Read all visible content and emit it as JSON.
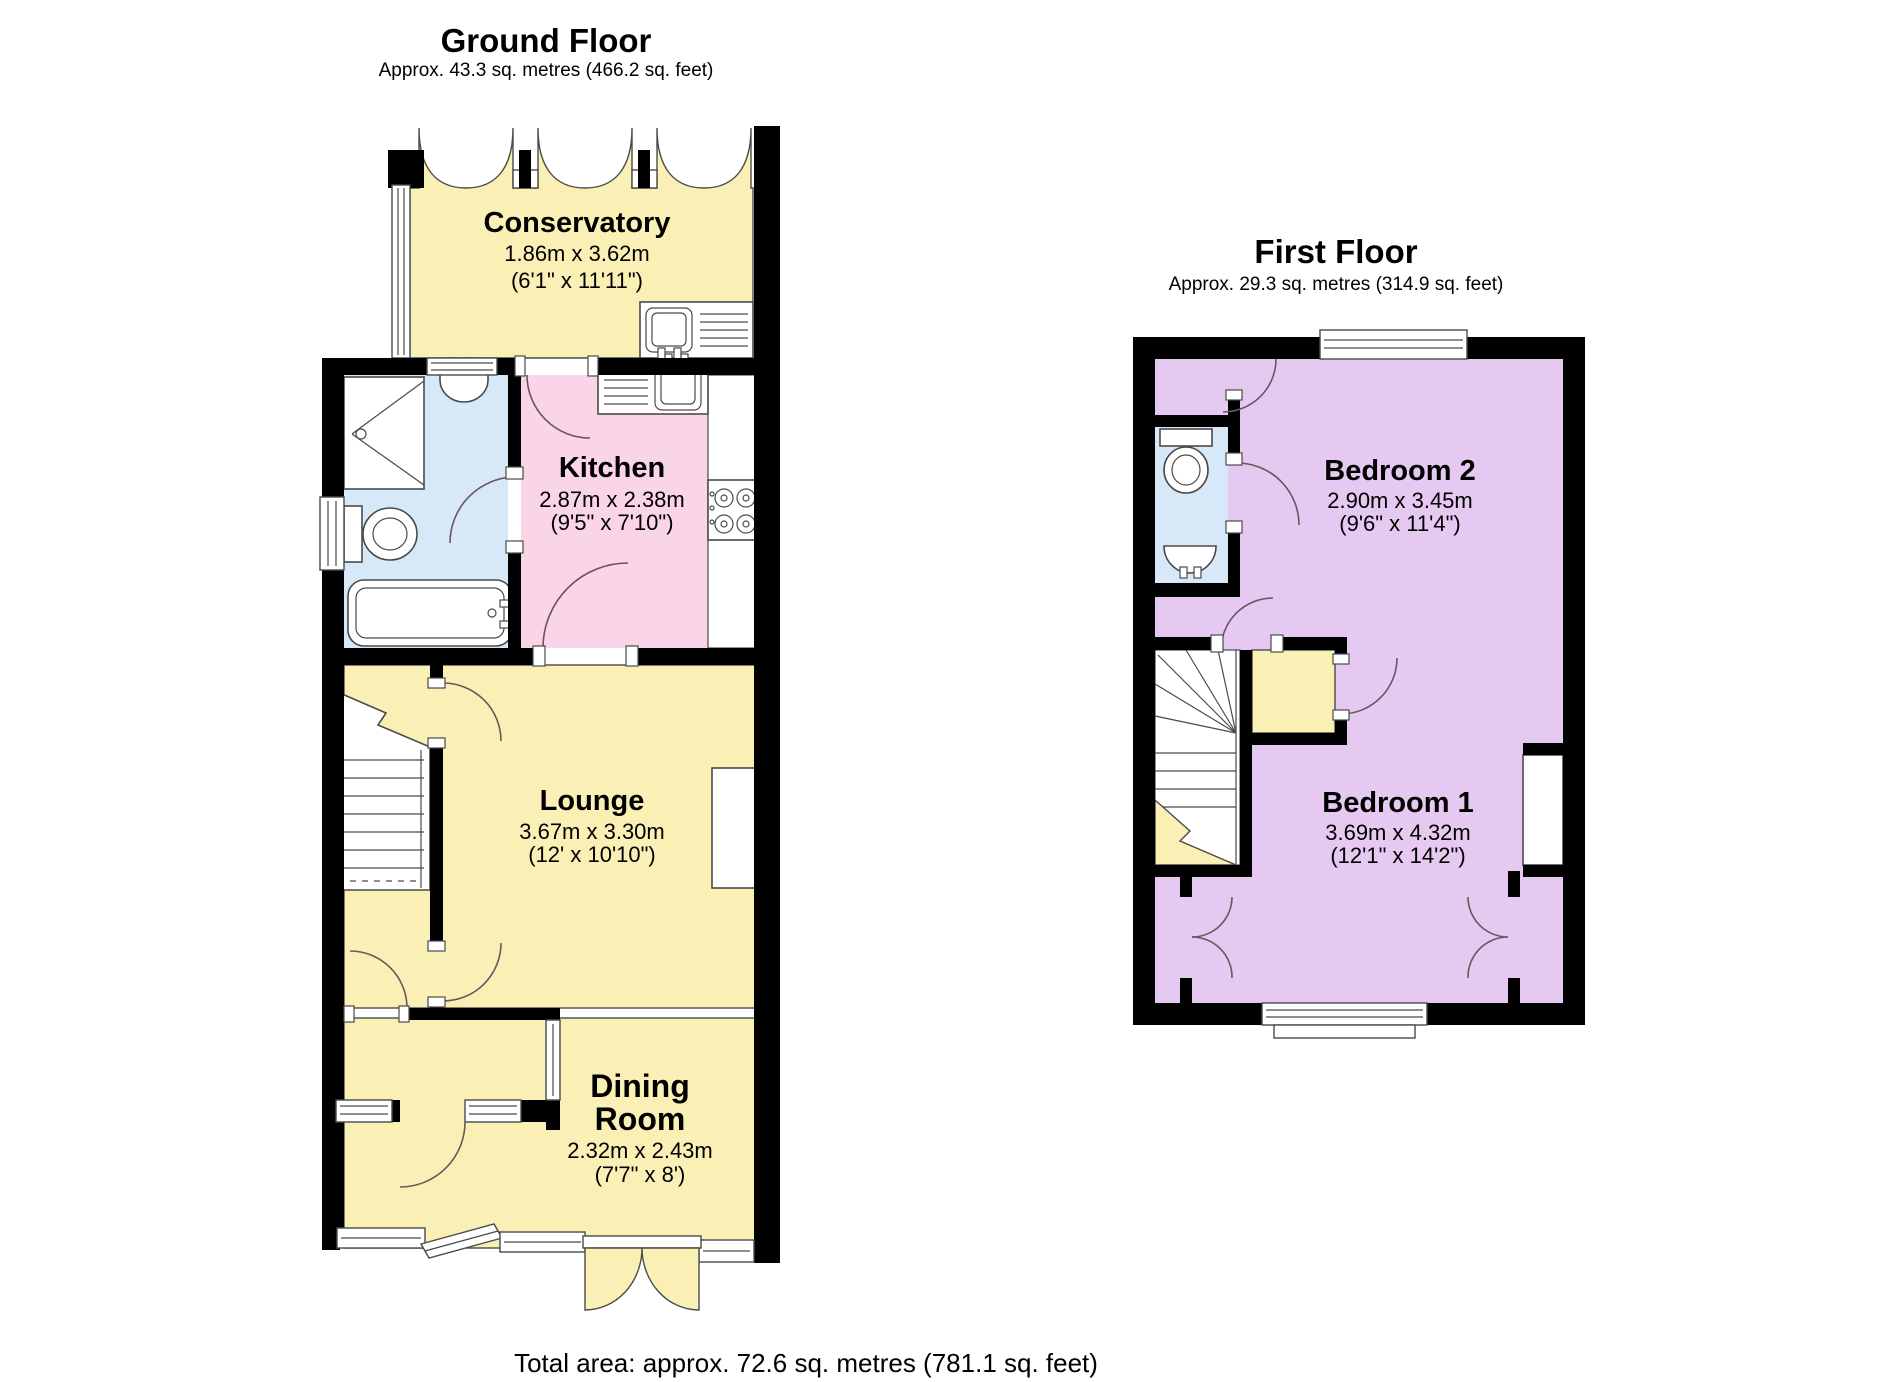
{
  "colors": {
    "room_yellow": "#FAF0B5",
    "kitchen_pink": "#F9D5E7",
    "bathroom_blue": "#D7E9F8",
    "bedroom_purple": "#E6C9F0",
    "wall_black": "#000000",
    "outline_gray": "#4a4a4a"
  },
  "ground_floor": {
    "title": "Ground Floor",
    "area": "Approx. 43.3 sq. metres (466.2 sq. feet)",
    "rooms": {
      "conservatory": {
        "name": "Conservatory",
        "metric": "1.86m x 3.62m",
        "imperial": "(6'1\" x 11'11\")"
      },
      "kitchen": {
        "name": "Kitchen",
        "metric": "2.87m x 2.38m",
        "imperial": "(9'5\" x 7'10\")"
      },
      "lounge": {
        "name": "Lounge",
        "metric": "3.67m x 3.30m",
        "imperial": "(12' x 10'10\")"
      },
      "dining": {
        "name_line1": "Dining",
        "name_line2": "Room",
        "metric": "2.32m x 2.43m",
        "imperial": "(7'7\" x 8')"
      }
    }
  },
  "first_floor": {
    "title": "First Floor",
    "area": "Approx. 29.3 sq. metres (314.9 sq. feet)",
    "rooms": {
      "bedroom2": {
        "name": "Bedroom 2",
        "metric": "2.90m x 3.45m",
        "imperial": "(9'6\" x 11'4\")"
      },
      "bedroom1": {
        "name": "Bedroom 1",
        "metric": "3.69m x 4.32m",
        "imperial": "(12'1\" x 14'2\")"
      }
    }
  },
  "total_area": "Total area: approx. 72.6 sq. metres (781.1 sq. feet)"
}
